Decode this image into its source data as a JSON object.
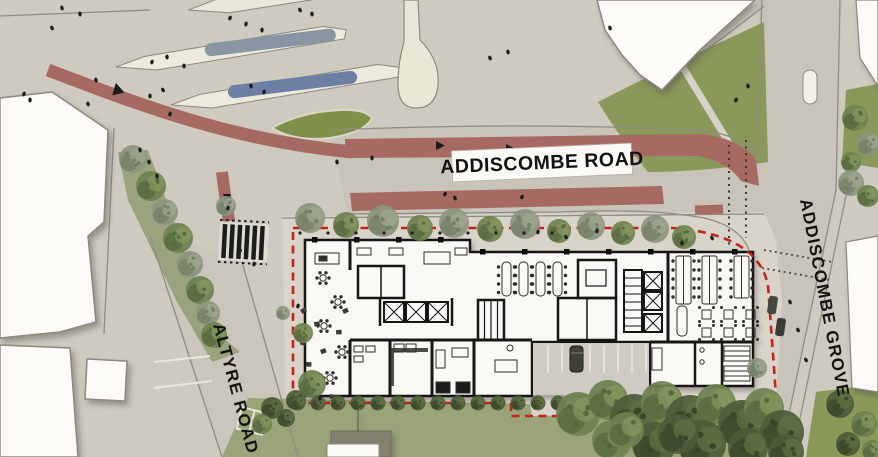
{
  "plan": {
    "type": "architectural-site-plan",
    "road_labels": {
      "addiscombe_road": "ADDISCOMBE ROAD",
      "addiscombe_grove": "ADDISCOMBE GROVE",
      "altyre_road": "ALTYRE ROAD"
    },
    "colors": {
      "paving": "#cecabf",
      "road_surface": "#c8c4ba",
      "site_paving": "#d8d4c9",
      "cycle_lane_red": "#a76a63",
      "site_boundary_red": "#c3231b",
      "lawn_green": "#9aa478",
      "tree_green": "#6e8150",
      "tram_platform_blue": "#6d80a4",
      "building_white": "#f9f8f4",
      "wall_black": "#141414"
    }
  }
}
